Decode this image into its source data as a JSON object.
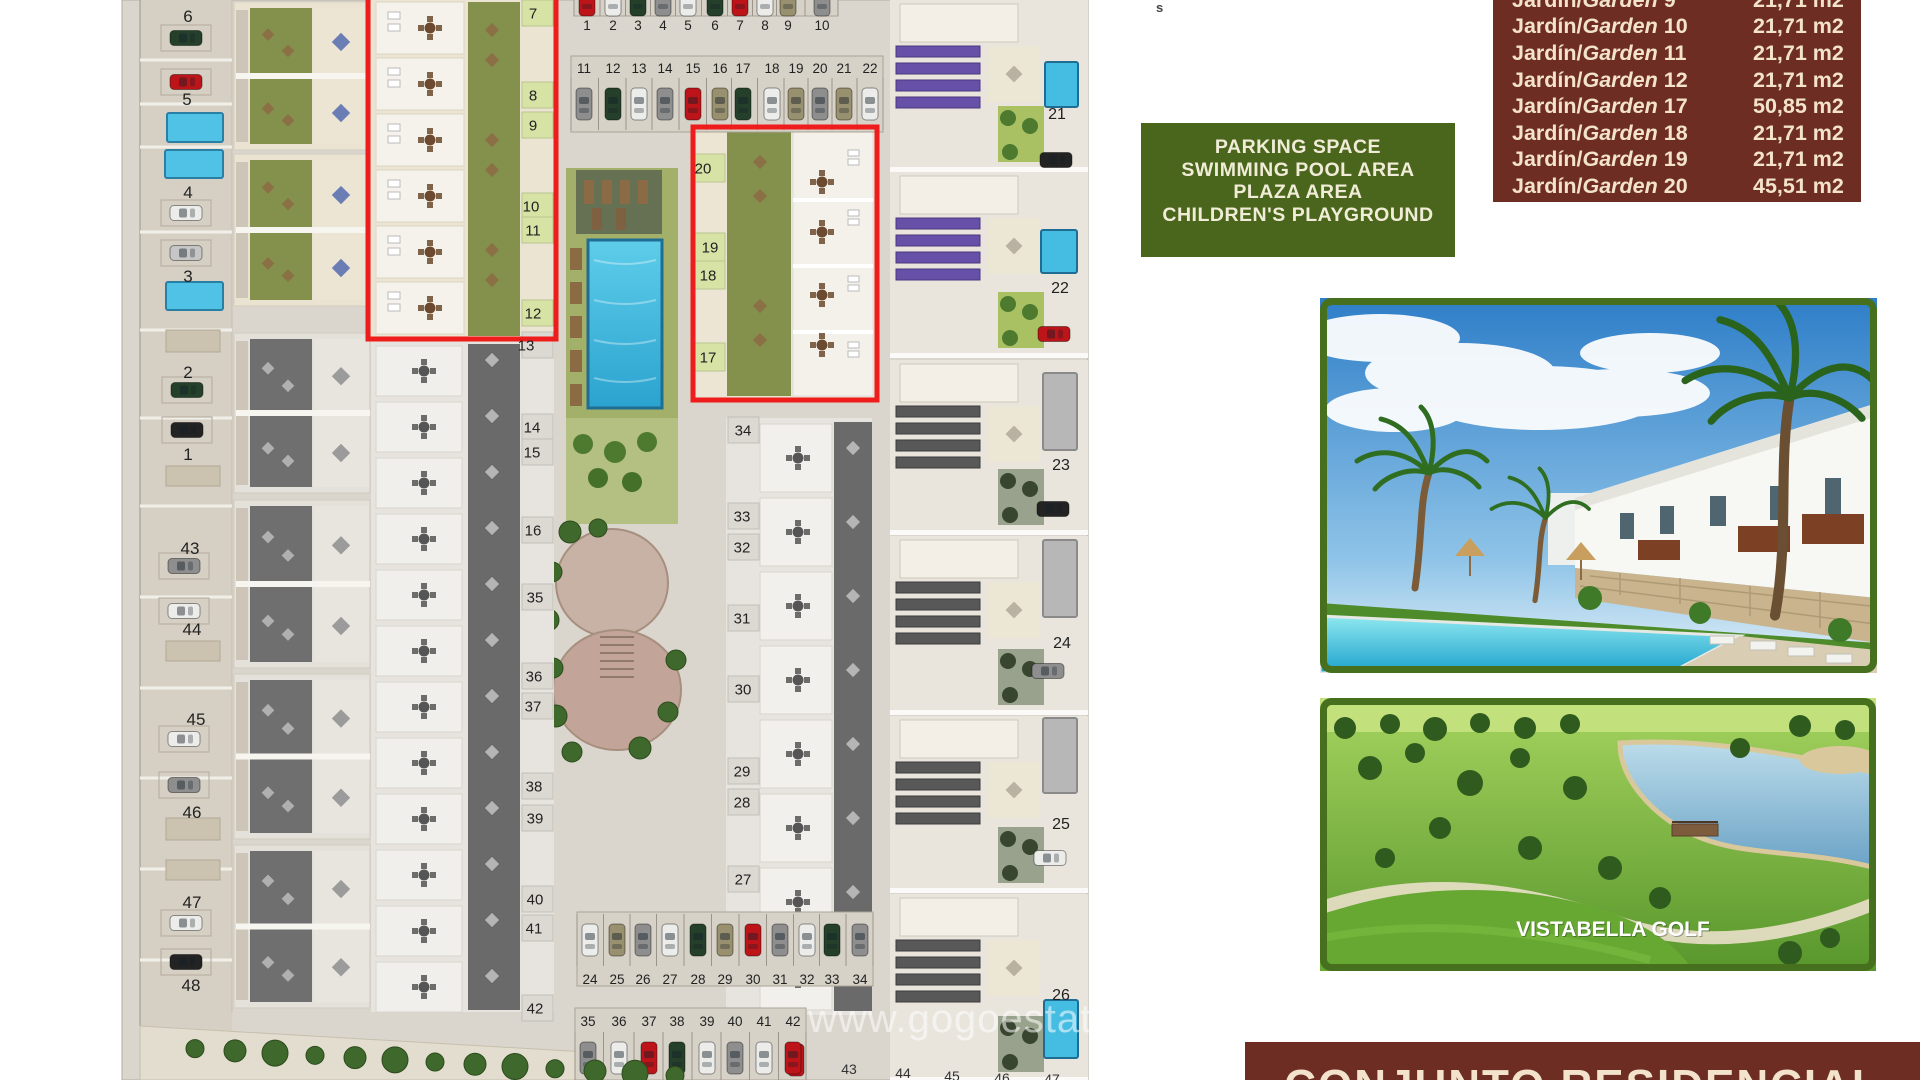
{
  "site_plan": {
    "watermark": "www.gogoestates.com",
    "stray_fragment": "s",
    "unit_labels": [
      [
        "6",
        188,
        16,
        17
      ],
      [
        "5",
        187,
        99,
        17
      ],
      [
        "4",
        188,
        192,
        17
      ],
      [
        "3",
        188,
        276,
        17
      ],
      [
        "2",
        188,
        372,
        17
      ],
      [
        "1",
        188,
        454,
        17
      ],
      [
        "43",
        190,
        548,
        17
      ],
      [
        "44",
        192,
        629,
        17
      ],
      [
        "45",
        196,
        719,
        17
      ],
      [
        "46",
        192,
        812,
        17
      ],
      [
        "47",
        192,
        902,
        17
      ],
      [
        "48",
        191,
        985,
        17
      ],
      [
        "7",
        533,
        13,
        15
      ],
      [
        "8",
        533,
        95,
        15
      ],
      [
        "9",
        533,
        125,
        15
      ],
      [
        "10",
        531,
        206,
        15
      ],
      [
        "11",
        533,
        230,
        15
      ],
      [
        "12",
        533,
        313,
        15
      ],
      [
        "13",
        526,
        345,
        15
      ],
      [
        "14",
        532,
        427,
        15
      ],
      [
        "15",
        532,
        452,
        15
      ],
      [
        "16",
        533,
        530,
        15
      ],
      [
        "35",
        535,
        597,
        15
      ],
      [
        "36",
        534,
        676,
        15
      ],
      [
        "37",
        533,
        706,
        15
      ],
      [
        "38",
        534,
        786,
        15
      ],
      [
        "39",
        535,
        818,
        15
      ],
      [
        "40",
        535,
        899,
        15
      ],
      [
        "41",
        534,
        928,
        15
      ],
      [
        "42",
        535,
        1008,
        15
      ],
      [
        "20",
        703,
        168,
        15
      ],
      [
        "19",
        710,
        247,
        15
      ],
      [
        "18",
        708,
        275,
        15
      ],
      [
        "17",
        708,
        357,
        15
      ],
      [
        "34",
        743,
        430,
        15
      ],
      [
        "33",
        742,
        516,
        15
      ],
      [
        "32",
        742,
        547,
        15
      ],
      [
        "31",
        742,
        618,
        15
      ],
      [
        "30",
        743,
        689,
        15
      ],
      [
        "29",
        742,
        771,
        15
      ],
      [
        "28",
        742,
        802,
        15
      ],
      [
        "27",
        743,
        879,
        15
      ],
      [
        "21",
        1057,
        113,
        16
      ],
      [
        "22",
        1060,
        287,
        16
      ],
      [
        "23",
        1061,
        464,
        16
      ],
      [
        "24",
        1062,
        642,
        16
      ],
      [
        "25",
        1061,
        823,
        16
      ],
      [
        "26",
        1061,
        994,
        16
      ]
    ],
    "edge_labels": [
      [
        "43",
        849,
        1069
      ],
      [
        "44",
        903,
        1073
      ],
      [
        "45",
        952,
        1076
      ],
      [
        "46",
        1002,
        1078
      ],
      [
        "47",
        1052,
        1079
      ]
    ],
    "green_cells": [
      "7",
      "8",
      "9",
      "10",
      "11",
      "12"
    ],
    "green_cells2": [
      "20",
      "19",
      "18",
      "17"
    ],
    "gray_cells": [
      "13",
      "14",
      "15",
      "16",
      "35",
      "36",
      "37",
      "38",
      "39",
      "40",
      "41",
      "42"
    ],
    "rc_cells": [
      "34",
      "33",
      "32",
      "31",
      "30",
      "29",
      "28",
      "27"
    ],
    "parking_rows": [
      {
        "label_y": 25,
        "car_cy": 0,
        "num_above": false,
        "strip": [
          574,
          -32,
          264,
          48
        ],
        "labels": [
          [
            "1",
            587
          ],
          [
            "2",
            613
          ],
          [
            "3",
            638
          ],
          [
            "4",
            663
          ],
          [
            "5",
            688
          ],
          [
            "6",
            715
          ],
          [
            "7",
            740
          ],
          [
            "8",
            765
          ],
          [
            "9",
            788
          ],
          [
            "10",
            822
          ]
        ],
        "cars": [
          "red",
          "white",
          "green",
          "gray",
          "white",
          "green",
          "red",
          "white",
          "khaki",
          "gray"
        ]
      },
      {
        "label_y": 68,
        "car_cy": 104,
        "num_above": true,
        "strip": [
          571,
          56,
          312,
          76
        ],
        "labels": [
          [
            "11",
            584
          ],
          [
            "12",
            613
          ],
          [
            "13",
            639
          ],
          [
            "14",
            665
          ],
          [
            "15",
            693
          ],
          [
            "16",
            720
          ],
          [
            "17",
            743
          ],
          [
            "18",
            772
          ],
          [
            "19",
            796
          ],
          [
            "20",
            820
          ],
          [
            "21",
            844
          ],
          [
            "22",
            870
          ]
        ],
        "cars": [
          "gray",
          "green",
          "white",
          "gray",
          "red",
          "khaki",
          "green",
          "white",
          "khaki",
          "gray",
          "khaki",
          "white"
        ]
      },
      {
        "label_y": 979,
        "car_cy": 940,
        "num_above": false,
        "strip": [
          577,
          912,
          296,
          74
        ],
        "labels": [
          [
            "24",
            590
          ],
          [
            "25",
            617
          ],
          [
            "26",
            643
          ],
          [
            "27",
            670
          ],
          [
            "28",
            698
          ],
          [
            "29",
            725
          ],
          [
            "30",
            753
          ],
          [
            "31",
            780
          ],
          [
            "32",
            807
          ],
          [
            "33",
            832
          ],
          [
            "34",
            860
          ]
        ],
        "cars": [
          "white",
          "khaki",
          "gray",
          "white",
          "green",
          "khaki",
          "red",
          "gray",
          "white",
          "green",
          "gray"
        ]
      },
      {
        "label_y": 1021,
        "car_cy": 1058,
        "num_above": true,
        "strip": [
          575,
          1008,
          231,
          72
        ],
        "labels": [
          [
            "35",
            588
          ],
          [
            "36",
            619
          ],
          [
            "37",
            649
          ],
          [
            "38",
            677
          ],
          [
            "39",
            707
          ],
          [
            "40",
            735
          ],
          [
            "41",
            764
          ],
          [
            "42",
            793
          ]
        ],
        "cars": [
          "gray",
          "white",
          "red",
          "green",
          "white",
          "gray",
          "white",
          "red"
        ]
      }
    ],
    "left_cars": [
      [
        186,
        38,
        "green"
      ],
      [
        186,
        82,
        "red"
      ],
      [
        186,
        213,
        "white"
      ],
      [
        186,
        253,
        "silver"
      ],
      [
        187,
        390,
        "green"
      ],
      [
        187,
        430,
        "black"
      ],
      [
        184,
        566,
        "gray"
      ],
      [
        184,
        611,
        "white"
      ],
      [
        184,
        739,
        "white"
      ],
      [
        184,
        785,
        "gray"
      ],
      [
        186,
        923,
        "white"
      ],
      [
        186,
        962,
        "black"
      ]
    ],
    "villa_cars": [
      [
        1056,
        160,
        "black"
      ],
      [
        1054,
        334,
        "red"
      ],
      [
        1053,
        509,
        "black"
      ],
      [
        1048,
        671,
        "gray"
      ],
      [
        1050,
        858,
        "white"
      ]
    ],
    "edge_car": [
      796,
      1060,
      "red"
    ],
    "left_pools": [
      [
        167,
        113,
        56,
        29
      ],
      [
        165,
        150,
        58,
        28
      ],
      [
        166,
        282,
        57,
        28
      ]
    ],
    "villa_pools": [
      [
        1045,
        62,
        33,
        45,
        1
      ],
      [
        1041,
        230,
        36,
        43,
        1
      ],
      [
        1043,
        373,
        34,
        77,
        0
      ],
      [
        1043,
        540,
        34,
        77,
        0
      ],
      [
        1043,
        718,
        34,
        75,
        0
      ],
      [
        1044,
        1000,
        34,
        58,
        1
      ]
    ],
    "highlight_boxes": [
      [
        368,
        -10,
        188,
        349
      ],
      [
        693,
        127,
        184,
        273
      ]
    ],
    "colors": {
      "highlight_red": "#ee1c1a",
      "maroon": "#6e2d22",
      "legend_green": "#4a661c",
      "cream": "#f3e3cc",
      "pool_blue": "#45bce2",
      "lawn_green": "#84914c"
    }
  },
  "garden_table": {
    "label_prefix": "Jardín/",
    "label_word": "Garden",
    "rows": [
      {
        "num": "9",
        "size": "21,71 m2",
        "partial": true
      },
      {
        "num": "10",
        "size": "21,71 m2"
      },
      {
        "num": "11",
        "size": "21,71 m2"
      },
      {
        "num": "12",
        "size": "21,71 m2"
      },
      {
        "num": "17",
        "size": "50,85 m2"
      },
      {
        "num": "18",
        "size": "21,71 m2"
      },
      {
        "num": "19",
        "size": "21,71 m2"
      },
      {
        "num": "20",
        "size": "45,51 m2"
      }
    ]
  },
  "legend_box": {
    "lines": [
      "PARKING SPACE",
      "SWIMMING POOL AREA",
      "PLAZA AREA",
      "CHILDREN'S PLAYGROUND"
    ]
  },
  "photos": {
    "golf_caption": "VISTABELLA GOLF"
  },
  "bottom_banner": {
    "text": "CONJUNTO RESIDENCIAL"
  }
}
